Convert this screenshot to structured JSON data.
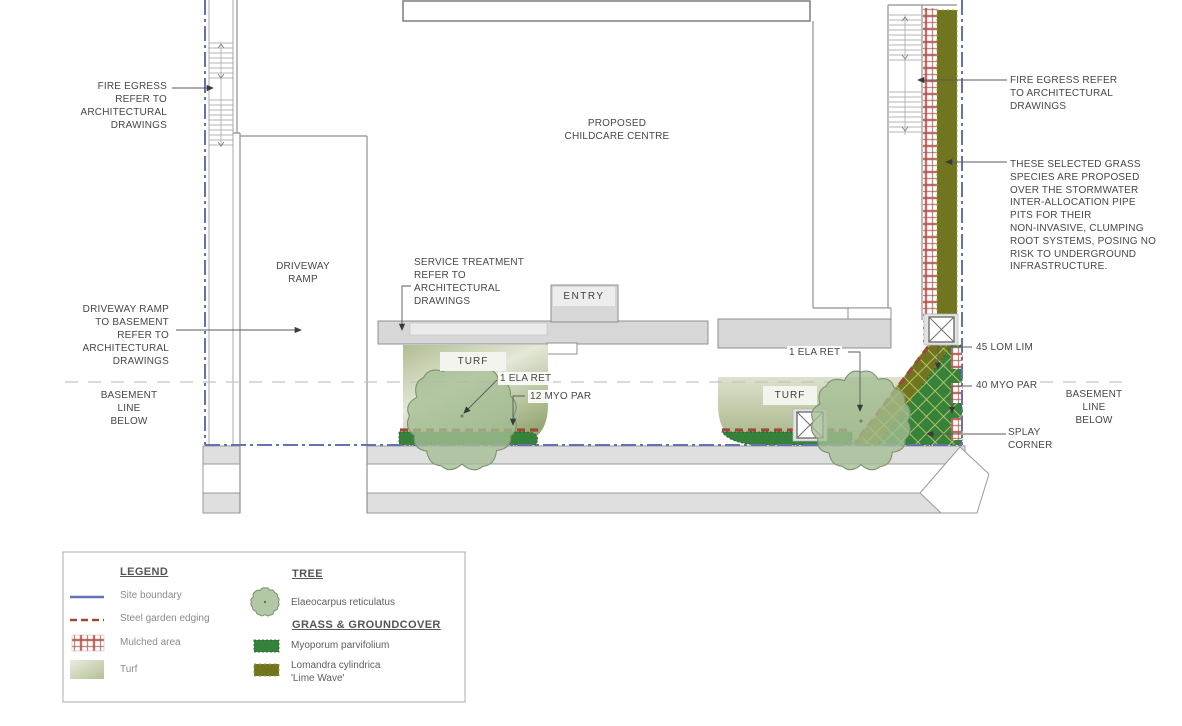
{
  "colors": {
    "site_boundary_blue": "#6471b5",
    "steel_edging_brown": "#9a4a3a",
    "mulch_red": "#b4544b",
    "myoporum_green": "#37823b",
    "lomandra_olive": "#71751f",
    "turf_light": "#e4e8d8",
    "turf_dark": "#96a773",
    "tree_fill": "#a4be94",
    "walkway_gray": "#d7d7d7",
    "outline_gray": "#8f8f8f",
    "basement_dash_gray": "#c4c4c4",
    "text": "#474747"
  },
  "plan": {
    "building_label": "PROPOSED\nCHILDCARE CENTRE",
    "entry_label": "ENTRY",
    "driveway_ramp_label": "DRIVEWAY\nRAMP",
    "turf_label_left": "TURF",
    "turf_label_right": "TURF"
  },
  "annotations": {
    "fire_egress_left": "FIRE EGRESS\nREFER TO\nARCHITECTURAL\nDRAWINGS",
    "driveway_ramp_note": "DRIVEWAY RAMP\nTO BASEMENT\nREFER TO\nARCHITECTURAL\nDRAWINGS",
    "basement_line_left": "BASEMENT\nLINE\nBELOW",
    "service_treatment": "SERVICE TREATMENT\nREFER TO\nARCHITECTURAL\nDRAWINGS",
    "tree_left": "1 ELA RET",
    "myoporum_left": "12 MYO PAR",
    "tree_right": "1 ELA RET",
    "fire_egress_right": "FIRE EGRESS REFER\nTO ARCHITECTURAL\nDRAWINGS",
    "grass_species_note": "THESE SELECTED GRASS\nSPECIES ARE PROPOSED\nOVER THE STORMWATER\nINTER-ALLOCATION PIPE\nPITS FOR THEIR\nNON-INVASIVE, CLUMPING\nROOT SYSTEMS, POSING NO\nRISK TO UNDERGROUND\nINFRASTRUCTURE.",
    "lomandra_count": "45 LOM LIM",
    "myoporum_right": "40 MYO PAR",
    "basement_line_right": "BASEMENT\nLINE\nBELOW",
    "splay_corner": "SPLAY\nCORNER"
  },
  "legend": {
    "title": "LEGEND",
    "items": [
      {
        "label": "Site boundary"
      },
      {
        "label": "Steel garden edging"
      },
      {
        "label": "Mulched area"
      },
      {
        "label": "Turf"
      }
    ],
    "tree_heading": "TREE",
    "tree_species": "Elaeocarpus reticulatus",
    "grass_heading": "GRASS & GROUNDCOVER",
    "grass_species": [
      {
        "label": "Myoporum parvifolium"
      },
      {
        "label": "Lomandra cylindrica\n'Lime Wave'"
      }
    ]
  }
}
